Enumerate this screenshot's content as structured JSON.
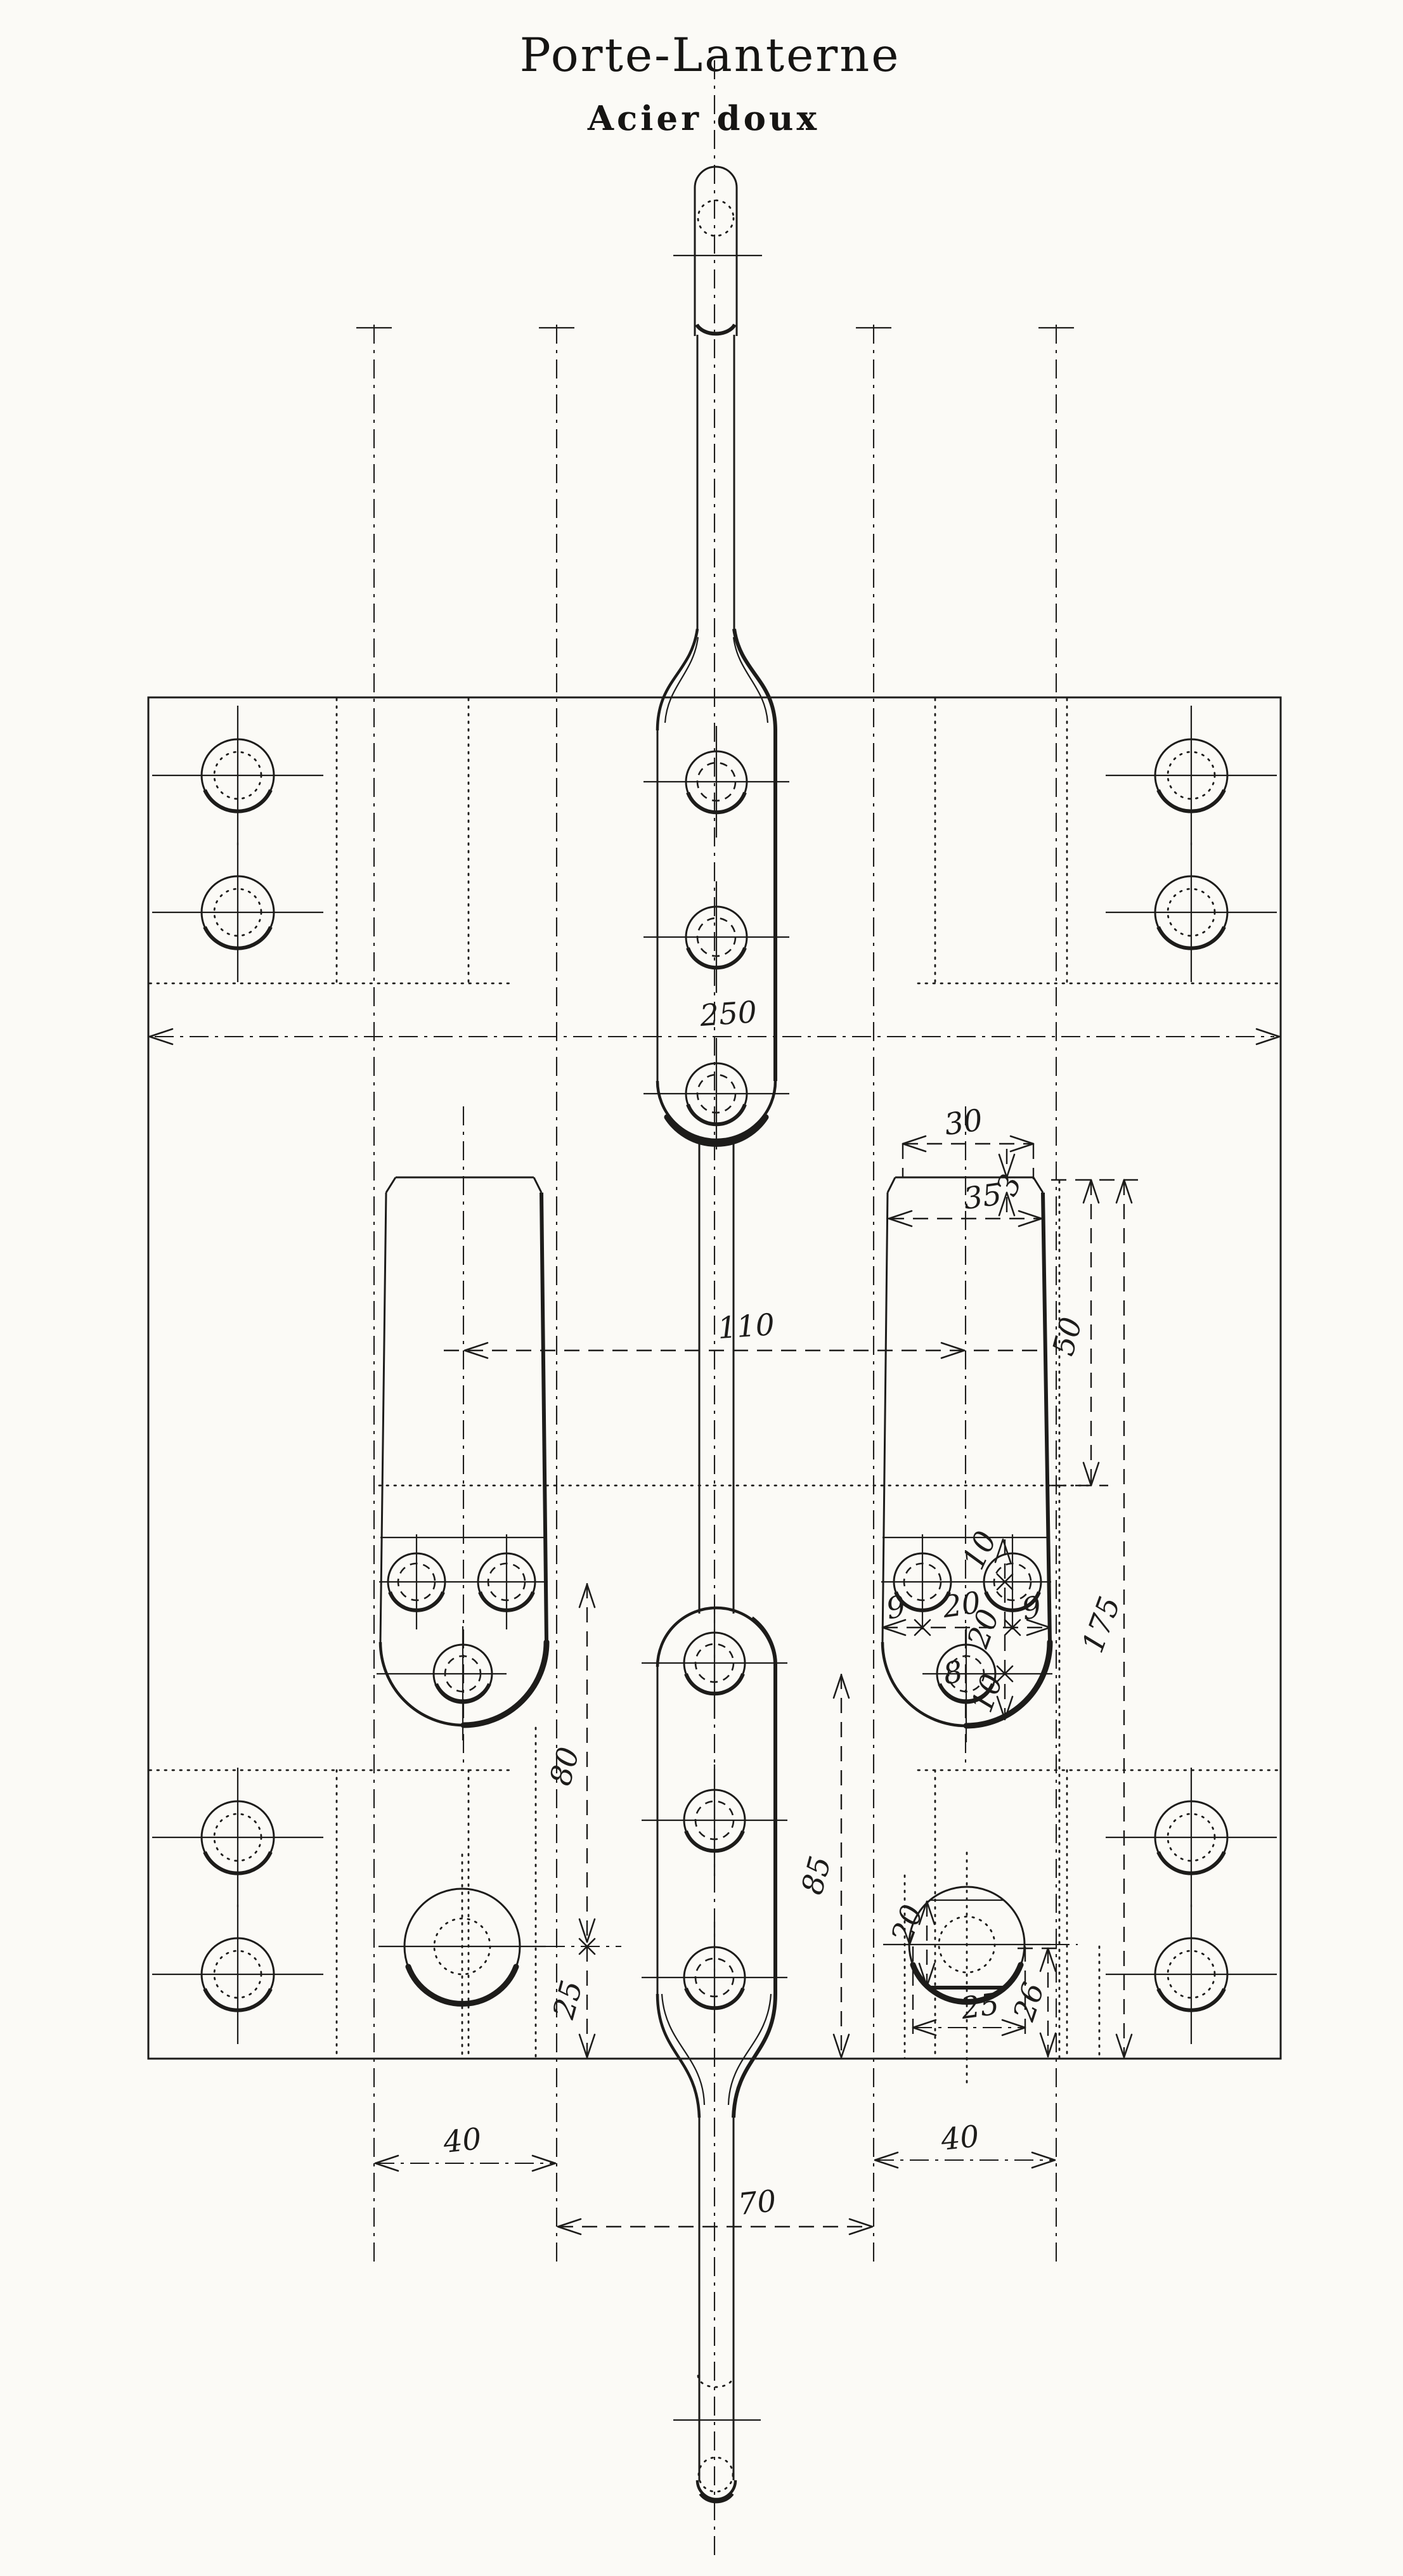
{
  "title": "Porte-Lanterne",
  "subtitle": "Acier doux",
  "dimensions": {
    "overall_width": "250",
    "lug_center_spacing": "110",
    "lug_top_width": "30",
    "chamfer_depth": "3",
    "lug_width": "35",
    "socket_depth": "50",
    "lug_total_height": "175",
    "neck_to_hole_row": "10",
    "edge_margin_left": "9",
    "hole_pitch": "20",
    "edge_margin_right": "9",
    "hole_row_drop": "20",
    "small_hole_diameter": "8",
    "hole_to_lug_end": "10",
    "hole_to_plate_bottom": "85",
    "hole_to_boss_center": "80",
    "boss_center_to_bottom_left": "25",
    "boss_flat_height": "20",
    "boss_width": "25",
    "boss_center_to_bottom_right": "26",
    "slot_width_left": "40",
    "slot_width_right": "40",
    "center_slot_span": "70"
  }
}
